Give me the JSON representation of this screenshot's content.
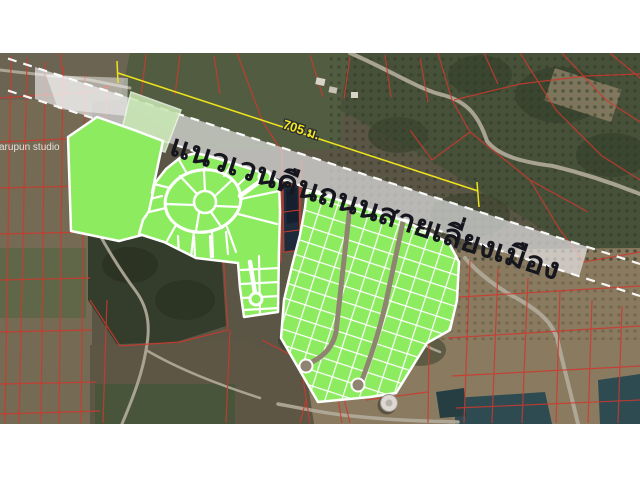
{
  "map": {
    "watermark": "Jarupun studio",
    "corridor": {
      "label": "แนวเวนคืนถนนสายเลี่ยงเมือง",
      "fill": "rgba(245,245,248,0.62)",
      "text_color": "#16161F"
    },
    "dimension": {
      "label": "705 ม.",
      "color": "#F0E71E"
    },
    "colors": {
      "parcel_green": "#8DEB5F",
      "parcel_green_pale": "#C9E8B4",
      "parcel_border": "#FFFFFF",
      "cadastral_red": "#CD392E",
      "road_gray": "#B3AC9C",
      "water_dark": "#2E4B52",
      "letterbox": "#FFFFFF"
    }
  }
}
